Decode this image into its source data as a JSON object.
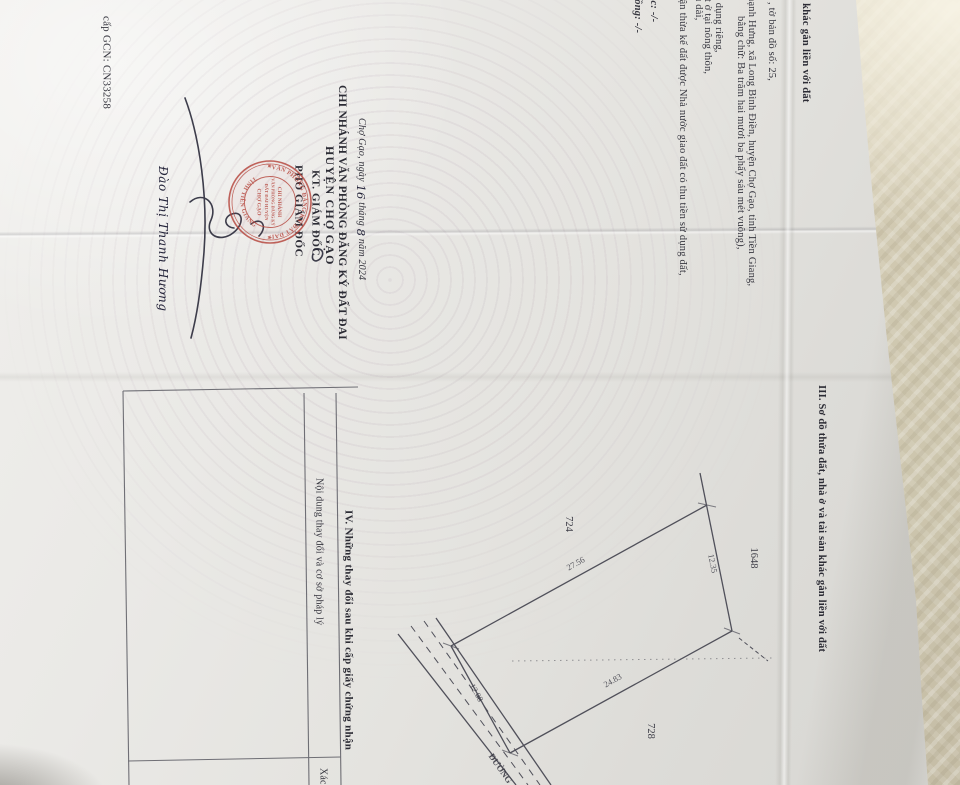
{
  "page2": {
    "issue_no": "cấp GCN: CN33258",
    "sec2_header_tail": "n khác gắn liền với đất",
    "lines": [
      ", tờ bản đồ số: 25,",
      "hạnh Hưng, xã Long Bình Điền, huyện Chợ Gạo, tỉnh Tiền Giang,",
      "bằng chữ: Ba trăm hai mươi ba phẩy sáu mét vuông),",
      "ử dụng riêng,",
      "ất ở tại nông thôn,",
      "u dài,",
      "hận thừa kế đất được Nhà nước giao đất có thu tiền sử dụng đất,",
      "ắc: -/-",
      "rồng: -/-"
    ],
    "sign": {
      "date_prefix": "Chợ Gạo, ngày ",
      "date_day": "16",
      "date_mid": " tháng ",
      "date_month": "8",
      "date_suffix": " năm 2024",
      "org1": "CHI NHÁNH VĂN PHÒNG ĐĂNG KÝ ĐẤT ĐAI",
      "org2": "HUYỆN CHỢ GẠO",
      "kt": "KT. GIÁM ĐỐC",
      "deputy": "PHÓ GIÁM ĐỐC",
      "signer": "Đào Thị Thanh Hương"
    },
    "stamp": {
      "ring_top": "VĂN PHÒNG ĐĂNG KÝ ĐẤT ĐAI",
      "ring_bottom": "TỈNH TIỀN GIANG",
      "star": "★",
      "c1": "CHI NHÁNH",
      "c2": "VĂN PHÒNG ĐĂNG KÝ",
      "c3": "ĐẤT ĐAI HUYỆN",
      "c4": "CHỢ GẠO",
      "color": "#b5443b"
    }
  },
  "page3": {
    "sec3_header": "III. Sơ đồ thửa đất, nhà ở và tài sản khác gắn liền với đất",
    "diagram": {
      "parcel_724": "724",
      "parcel_1648": "1648",
      "parcel_728": "728",
      "len_top": "27.56",
      "len_right": "12.35",
      "len_bottom": "24.83",
      "len_left": "12.08",
      "road": "ĐƯỜNG"
    },
    "sec4_header": "IV. Những thay đổi sau khi cấp giấy chứng nhận",
    "table_col1": "Nội dung thay đổi và cơ sở pháp lý",
    "table_col2": "Xác"
  }
}
